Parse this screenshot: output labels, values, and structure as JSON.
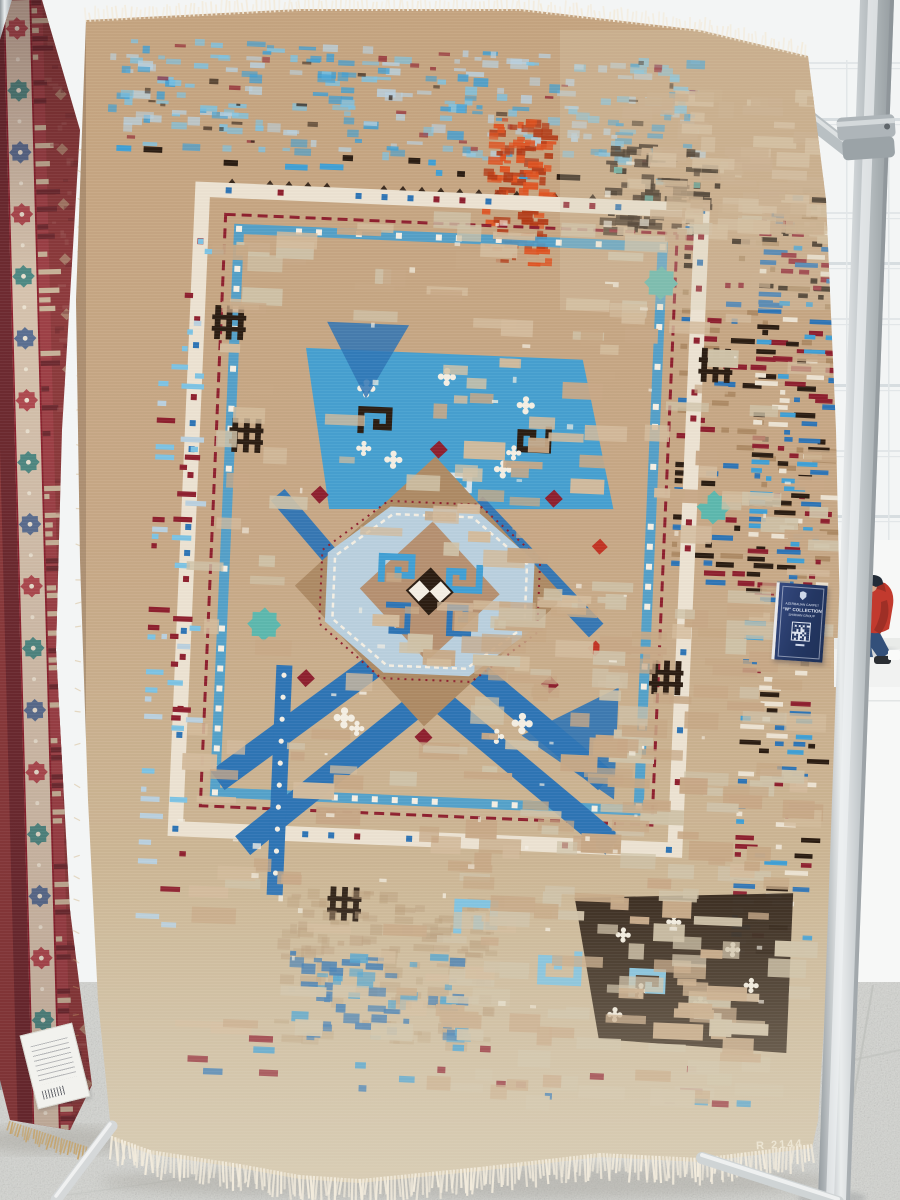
{
  "label_tag": {
    "line1": "AZERBAIJAN CARPET",
    "line2": "“W” COLLECTION",
    "line3": "SHIRVAN GROUP"
  },
  "main_carpet": {
    "signature": "R 2144"
  },
  "colors": {
    "atrium_white": "#f3f5f5",
    "wall_line": "#e2e6e8",
    "wall_line_dark": "#d7dde0",
    "floor_gray": "#d3d4d0",
    "grout": "#bfc1bd",
    "pole_light": "#e9eced",
    "pole_mid": "#c3c9cc",
    "pole_dark": "#949b9f",
    "clamp_gray": "#aeb5b9",
    "field": "#c7a886",
    "field_light": "#d3bb9c",
    "field_pale": "#cfc2a8",
    "tan": "#ad8a64",
    "tan_ghost": "#b99d7b",
    "sky": "#3f9fd4",
    "sky_light": "#7cc3e4",
    "cobalt": "#2e74b5",
    "ice": "#b9d0de",
    "ice_light": "#d6e3ea",
    "maroon": "#8e1f2e",
    "red": "#c23324",
    "orange": "#df5220",
    "orange_dark": "#b23a16",
    "dark": "#2a1c12",
    "teal": "#5cb8ae",
    "cream": "#ece3d2",
    "white_motif": "#f4efe4",
    "fringe": "#f3ecdd",
    "fringe_gold": "#c7a265",
    "red_carpet_field": "#8d3a3c",
    "red_carpet_dark": "#6e2a30",
    "red_carpet_band": "#9e4046",
    "red_carpet_cream": "#d6c3ae",
    "red_carpet_rose": "#b04a50",
    "red_carpet_teal": "#4e8a84",
    "red_carpet_navy": "#5a6f92",
    "tag_navy": "#2b3f74",
    "jacket_red": "#c23a2e",
    "jacket_dark": "#9e2f26",
    "cap_dark": "#232c38",
    "jeans_blue": "#3e5c85",
    "skin": "#d8a98c",
    "shoe_dark": "#2a2e33",
    "bench_white": "#f1f2f1"
  }
}
